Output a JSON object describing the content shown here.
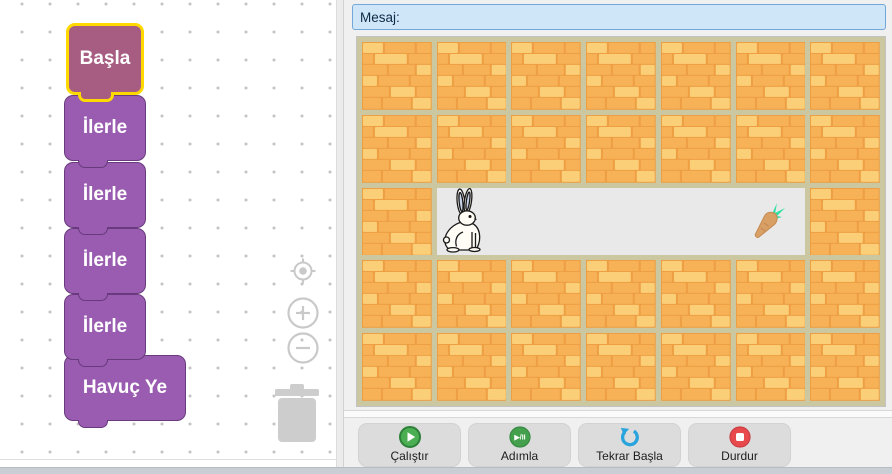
{
  "workspace": {
    "blocks": [
      {
        "label": "Başla",
        "type": "start",
        "selected": true
      },
      {
        "label": "İlerle",
        "type": "command",
        "selected": false
      },
      {
        "label": "İlerle",
        "type": "command",
        "selected": false
      },
      {
        "label": "İlerle",
        "type": "command",
        "selected": false
      },
      {
        "label": "İlerle",
        "type": "command",
        "selected": false
      },
      {
        "label": "Havuç Ye",
        "type": "command",
        "selected": false
      }
    ]
  },
  "message_bar": {
    "label": "Mesaj:"
  },
  "stage": {
    "grid": [
      "BBBBBBB",
      "BBBBBBB",
      "BPPPPPB",
      "BBBBBBB",
      "BBBBBBB"
    ],
    "sprites": [
      {
        "name": "rabbit",
        "row": 2,
        "col": 1
      },
      {
        "name": "carrot",
        "row": 2,
        "col": 5
      }
    ]
  },
  "controls": [
    {
      "label": "Çalıştır",
      "icon": "play-icon"
    },
    {
      "label": "Adımla",
      "icon": "step-icon"
    },
    {
      "label": "Tekrar Başla",
      "icon": "restart-icon"
    },
    {
      "label": "Durdur",
      "icon": "stop-icon"
    }
  ],
  "colors": {
    "block_purple": "#9a5cb0",
    "block_start_mauve": "#a75d81",
    "selection_yellow": "#ffd800",
    "brick_orange": "#f7b157",
    "brick_light": "#fbcf78",
    "mortar_gap_khaki": "#cbc8a1",
    "path_gray": "#e9e9e9",
    "message_bg": "#cfe6f9",
    "message_border": "#74a7d9",
    "run_green": "#4cae52",
    "restart_blue": "#2aa4dd",
    "stop_red": "#e8494d"
  }
}
